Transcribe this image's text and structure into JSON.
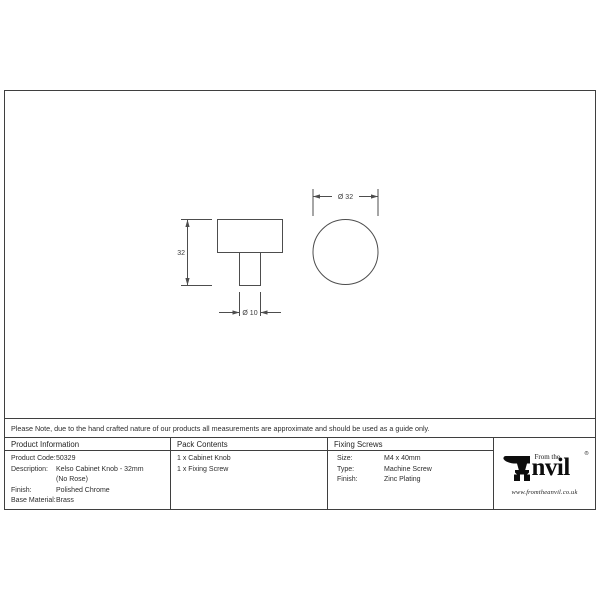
{
  "drawing": {
    "side_view": {
      "height_label": "32",
      "stem_diameter_label": "Ø 10"
    },
    "front_view": {
      "diameter_label": "Ø 32"
    }
  },
  "note": {
    "text": "Please Note, due to the hand crafted nature of our products all measurements are approximate and should be used as a guide only."
  },
  "table": {
    "product_information": {
      "header": "Product Information",
      "rows": [
        {
          "label": "Product Code:",
          "value": "50329"
        },
        {
          "label": "Description:",
          "value": "Kelso Cabinet Knob - 32mm"
        },
        {
          "label": "",
          "value": "(No Rose)"
        },
        {
          "label": "Finish:",
          "value": "Polished Chrome"
        },
        {
          "label": "Base Material:",
          "value": "Brass"
        }
      ]
    },
    "pack_contents": {
      "header": "Pack Contents",
      "items": [
        "1 x Cabinet Knob",
        "1 x Fixing Screw"
      ]
    },
    "fixing_screws": {
      "header": "Fixing Screws",
      "rows": [
        {
          "label": "Size:",
          "value": "M4 x 40mm"
        },
        {
          "label": "Type:",
          "value": "Machine Screw"
        },
        {
          "label": "Finish:",
          "value": "Zinc Plating"
        }
      ]
    },
    "logo": {
      "brand_top": "From the",
      "brand_main": "nvil",
      "registered_mark": "®",
      "website": "www.fromtheanvil.co.uk"
    }
  },
  "colors": {
    "frame_line": "#3f3f3f",
    "drawing_line": "#4d4d4d",
    "logo_ink": "#0d0d0d",
    "background": "#ffffff"
  }
}
